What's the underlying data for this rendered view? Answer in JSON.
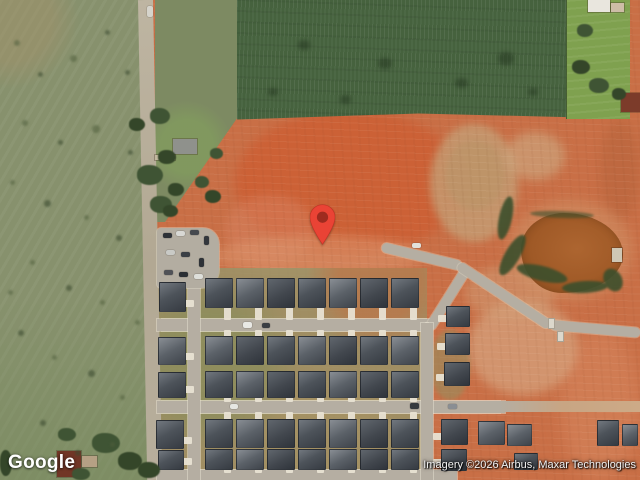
{
  "map": {
    "view_type": "satellite",
    "provider_logo": "Google",
    "attribution": "Imagery ©2026 Airbus, Maxar Technologies",
    "marker": {
      "shape": "google-map-pin",
      "tip_x": 322,
      "tip_y": 245
    }
  },
  "palette": {
    "dirt": "#c96f46",
    "dirt-bright": "#cd5f33",
    "tan": "#c5a078",
    "pasture": "#87916d",
    "crop": "#46623e",
    "lawn": "#7fa14f",
    "pond": "#a05a27",
    "veg": "#3c4f2c",
    "street": "#b5aea2",
    "drive": "#e8e2d3",
    "marker-red": "#EA4335",
    "marker-core": "#9e2b1f"
  },
  "features": {
    "house_rows": [
      {
        "x": 205,
        "y": 278,
        "w": 28,
        "h": 30,
        "count": 7,
        "gap": 3,
        "drive": "down",
        "dl": 14
      },
      {
        "x": 205,
        "y": 336,
        "w": 28,
        "h": 29,
        "count": 7,
        "gap": 3,
        "drive": "up",
        "dl": 8
      },
      {
        "x": 205,
        "y": 371,
        "w": 28,
        "h": 27,
        "count": 7,
        "gap": 3,
        "drive": "down",
        "dl": 6
      },
      {
        "x": 205,
        "y": 419,
        "w": 28,
        "h": 29,
        "count": 7,
        "gap": 3,
        "drive": "up",
        "dl": 9
      },
      {
        "x": 205,
        "y": 449,
        "w": 28,
        "h": 21,
        "count": 7,
        "gap": 3,
        "drive": "down",
        "dl": 5
      }
    ],
    "houses": [
      [
        159,
        282,
        27,
        30,
        "right"
      ],
      [
        158,
        337,
        28,
        28,
        "right"
      ],
      [
        158,
        372,
        28,
        26,
        "right"
      ],
      [
        156,
        420,
        28,
        29,
        "right"
      ],
      [
        158,
        450,
        26,
        20,
        "right"
      ],
      [
        446,
        306,
        24,
        21,
        "left"
      ],
      [
        445,
        333,
        25,
        22,
        "left"
      ],
      [
        444,
        362,
        26,
        24,
        "left"
      ],
      [
        441,
        419,
        27,
        26,
        "left"
      ],
      [
        441,
        449,
        26,
        22,
        "left"
      ],
      [
        478,
        421,
        27,
        24,
        null
      ],
      [
        507,
        424,
        25,
        22,
        null
      ],
      [
        597,
        420,
        22,
        26,
        null
      ],
      [
        622,
        424,
        16,
        22,
        null
      ],
      [
        514,
        453,
        24,
        17,
        null
      ]
    ],
    "structures": [
      [
        173,
        139,
        24,
        15,
        "#8f918c"
      ],
      [
        155,
        155,
        20,
        5,
        "#c2b89f"
      ],
      [
        57,
        451,
        24,
        26,
        "#713626"
      ],
      [
        82,
        456,
        15,
        11,
        "#b5a084"
      ],
      [
        588,
        0,
        22,
        12,
        "#e9e6de"
      ],
      [
        611,
        3,
        13,
        9,
        "#cdbda6"
      ],
      [
        621,
        93,
        19,
        19,
        "#7c3b2a"
      ],
      [
        612,
        248,
        10,
        14,
        "#cfc7b5"
      ]
    ],
    "trees": [
      [
        150,
        108,
        20,
        16
      ],
      [
        129,
        118,
        16,
        13
      ],
      [
        137,
        165,
        26,
        20
      ],
      [
        158,
        150,
        18,
        14
      ],
      [
        150,
        196,
        22,
        17
      ],
      [
        168,
        183,
        16,
        13
      ],
      [
        195,
        176,
        14,
        12
      ],
      [
        205,
        190,
        16,
        13
      ],
      [
        210,
        148,
        13,
        11
      ],
      [
        163,
        205,
        15,
        12
      ],
      [
        577,
        24,
        16,
        13
      ],
      [
        572,
        60,
        18,
        14
      ],
      [
        589,
        78,
        20,
        15
      ],
      [
        612,
        88,
        14,
        12
      ],
      [
        92,
        433,
        28,
        20
      ],
      [
        118,
        452,
        24,
        18
      ],
      [
        58,
        428,
        18,
        13
      ],
      [
        138,
        462,
        22,
        16
      ],
      [
        72,
        468,
        18,
        12
      ],
      [
        0,
        450,
        12,
        26
      ]
    ],
    "field_spots": [
      [
        498,
        52,
        16
      ],
      [
        455,
        78,
        13
      ],
      [
        528,
        88,
        10
      ],
      [
        378,
        58,
        14
      ],
      [
        298,
        40,
        12
      ],
      [
        268,
        88,
        10
      ],
      [
        340,
        95,
        11
      ]
    ],
    "pasture_spots": [
      [
        14,
        40,
        6
      ],
      [
        38,
        72,
        5
      ],
      [
        70,
        55,
        7
      ],
      [
        105,
        30,
        5
      ],
      [
        22,
        120,
        6
      ],
      [
        58,
        140,
        5
      ],
      [
        92,
        125,
        8
      ],
      [
        128,
        150,
        5
      ],
      [
        10,
        180,
        5
      ],
      [
        44,
        200,
        7
      ],
      [
        84,
        215,
        5
      ],
      [
        116,
        235,
        6
      ],
      [
        30,
        260,
        5
      ],
      [
        66,
        285,
        6
      ],
      [
        100,
        300,
        5
      ],
      [
        18,
        330,
        6
      ],
      [
        52,
        355,
        5
      ],
      [
        88,
        370,
        7
      ],
      [
        120,
        395,
        5
      ],
      [
        40,
        420,
        6
      ],
      [
        8,
        290,
        5
      ],
      [
        125,
        70,
        5
      ],
      [
        135,
        320,
        5
      ],
      [
        75,
        450,
        6
      ],
      [
        110,
        442,
        5
      ]
    ],
    "cars_parking": [
      [
        163,
        233,
        9,
        5,
        "#2e3237"
      ],
      [
        176,
        231,
        9,
        5,
        "#d8d8d4"
      ],
      [
        190,
        230,
        9,
        5,
        "#45494e"
      ],
      [
        204,
        236,
        5,
        9,
        "#33373c"
      ],
      [
        166,
        250,
        9,
        5,
        "#c9cac6"
      ],
      [
        181,
        252,
        9,
        5,
        "#3a3f45"
      ],
      [
        199,
        258,
        5,
        9,
        "#2e3237"
      ],
      [
        164,
        270,
        9,
        5,
        "#505257"
      ],
      [
        179,
        272,
        9,
        5,
        "#2b2f34"
      ],
      [
        194,
        274,
        9,
        5,
        "#dedfda"
      ]
    ],
    "cars_street": [
      [
        243,
        322,
        9,
        6,
        "#e9e9e5"
      ],
      [
        262,
        323,
        8,
        5,
        "#3a3e43"
      ],
      [
        410,
        403,
        9,
        6,
        "#35393e"
      ],
      [
        448,
        404,
        9,
        5,
        "#8a8e93"
      ],
      [
        230,
        404,
        8,
        5,
        "#e6e6e2"
      ],
      [
        147,
        6,
        6,
        11,
        "#d6d4cc"
      ],
      [
        412,
        243,
        9,
        5,
        "#e2e1db"
      ]
    ],
    "potties": [
      [
        548,
        318,
        7,
        11
      ],
      [
        557,
        331,
        7,
        11
      ]
    ]
  }
}
